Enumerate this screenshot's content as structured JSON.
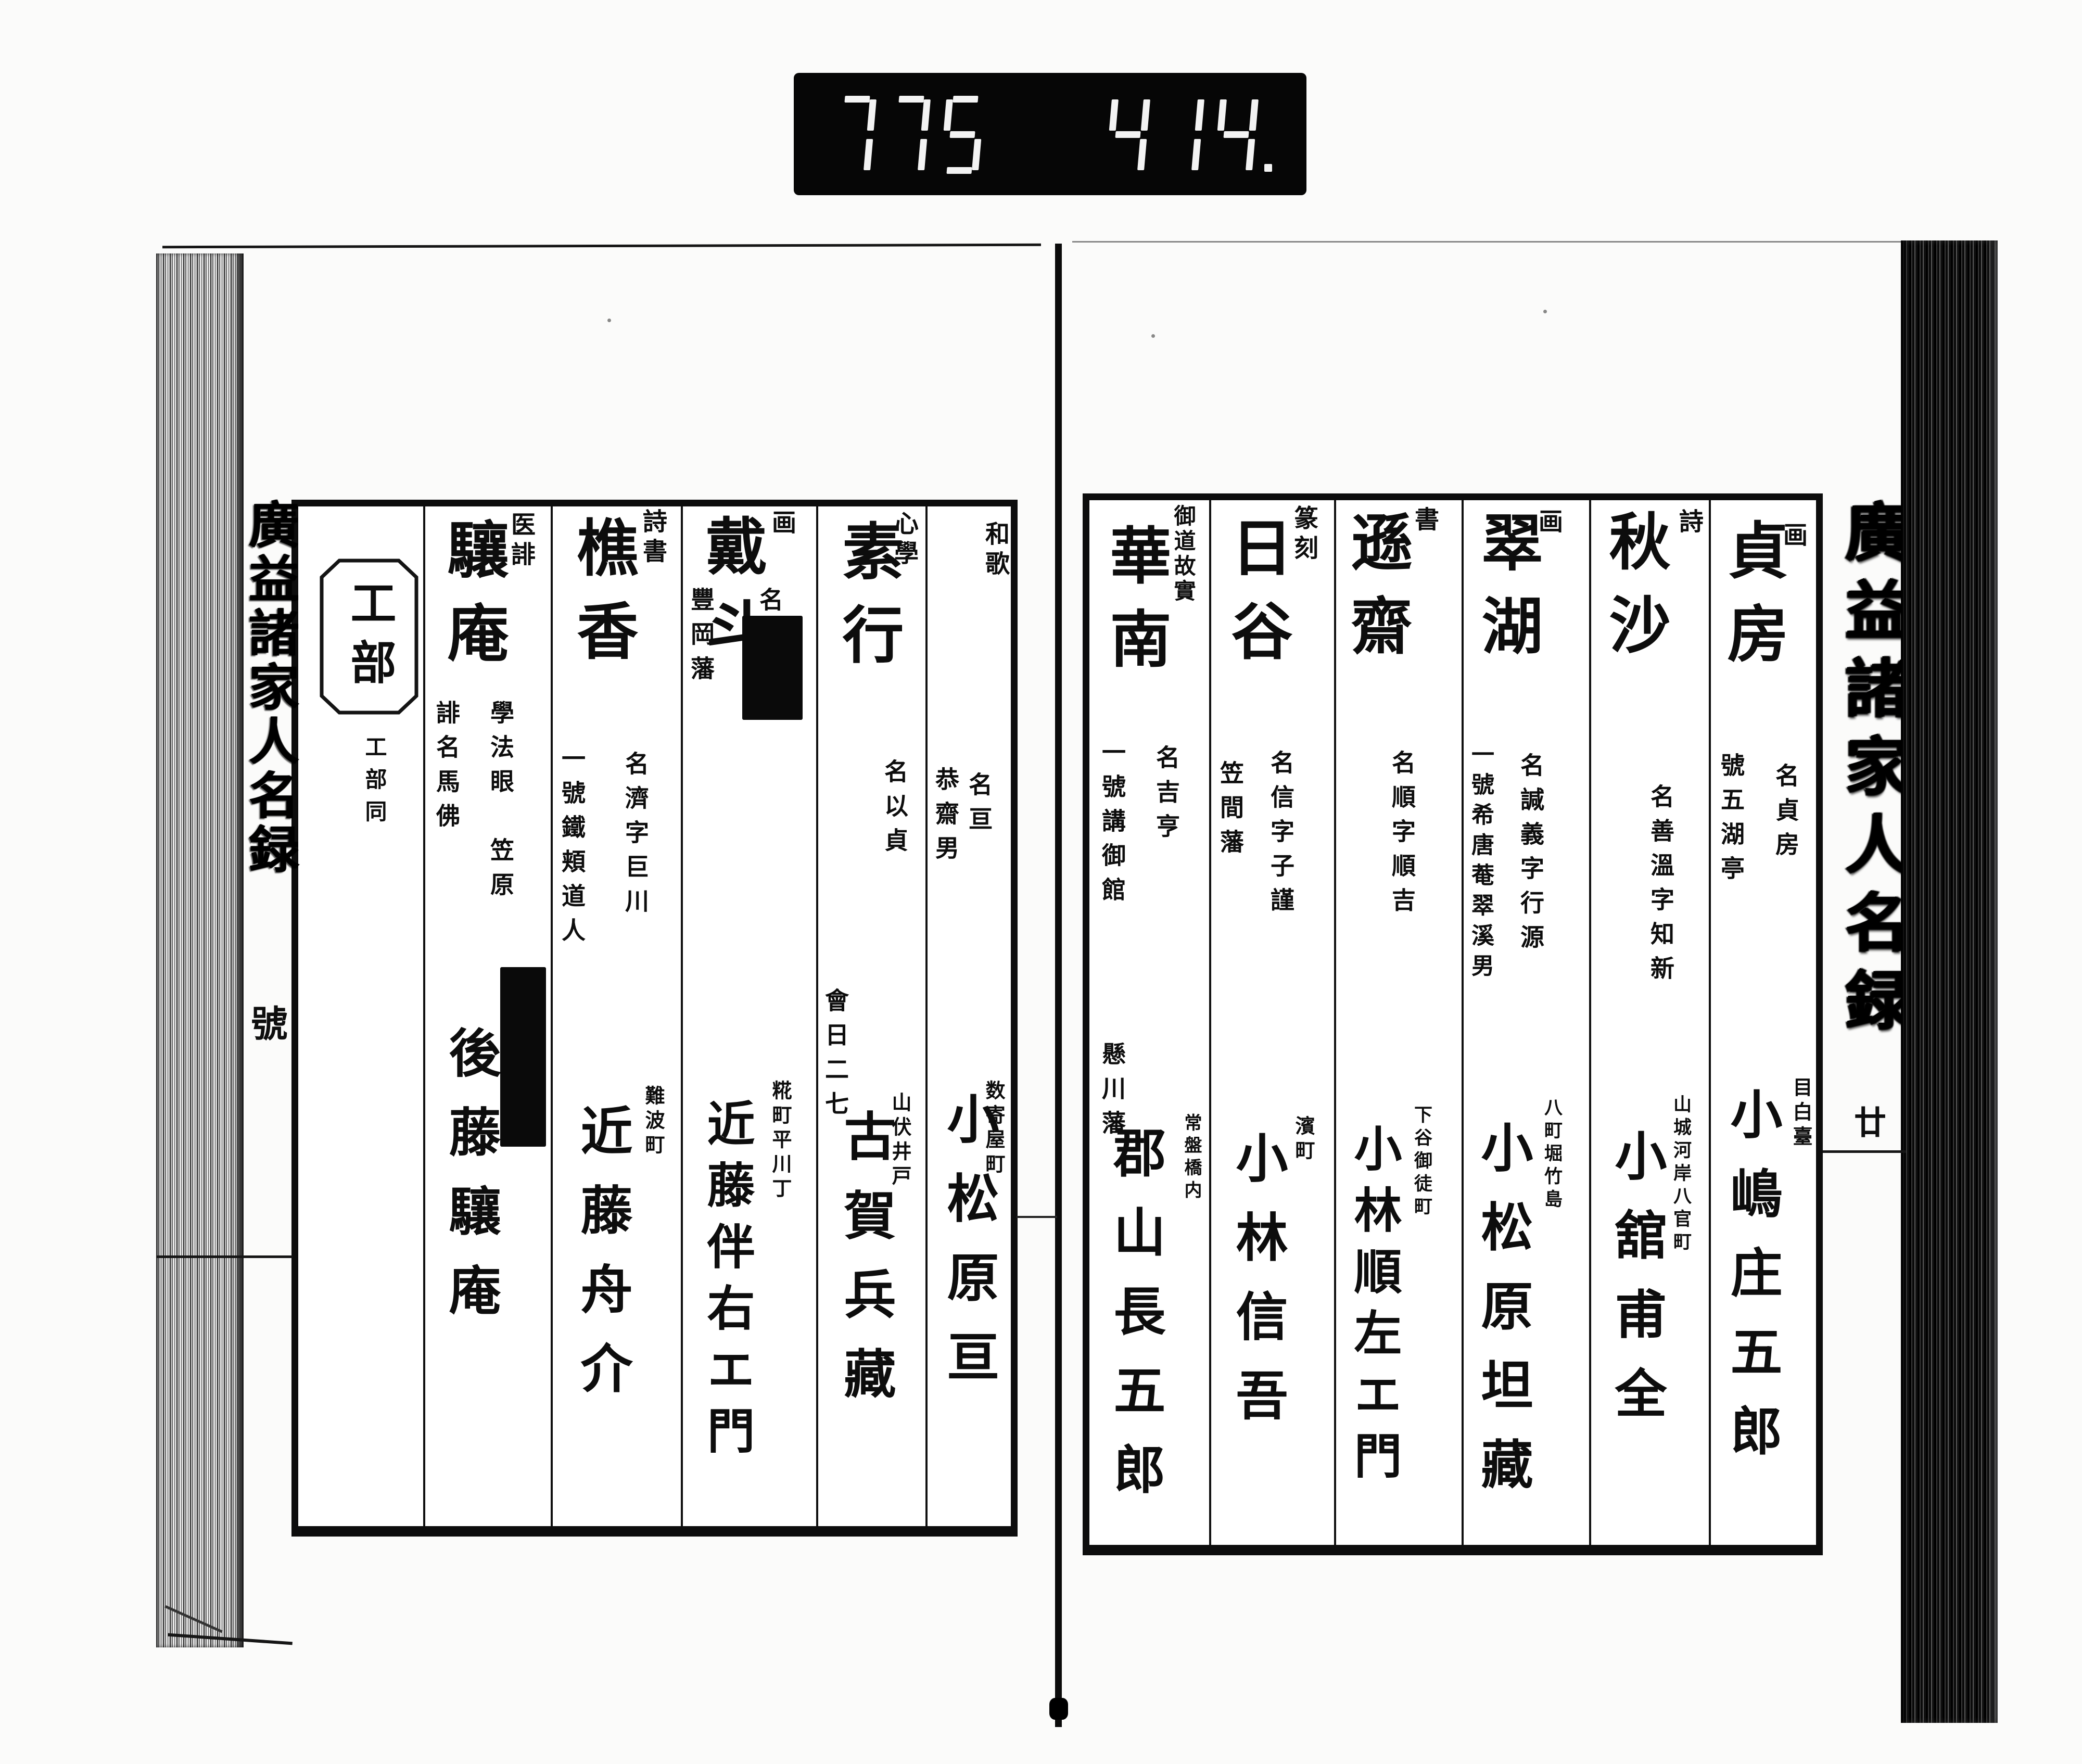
{
  "counter": {
    "left": "775",
    "right": "414."
  },
  "book": {
    "right_page": {
      "margin_title": "廣益諸家人名録",
      "margin_mark": "廿",
      "entries": [
        {
          "category": "画",
          "name": "貞房",
          "note_right": "名貞房",
          "note_left": "號五湖亭",
          "address": "目白臺",
          "person": "小嶋庄五郎"
        },
        {
          "category": "詩",
          "name": "秋沙",
          "note_right": "名善溫字知新",
          "note_left": "",
          "address": "山城河岸八官町",
          "person": "小舘甫全"
        },
        {
          "category": "画",
          "name": "翠湖",
          "note_right": "名諴義字行源",
          "note_left": "一號希唐菴翠溪男",
          "address": "八町堀竹島",
          "person": "小松原坦藏"
        },
        {
          "category": "書",
          "name": "遜齋",
          "note_right": "名順字順吉",
          "note_left": "",
          "address": "下谷御徒町",
          "person": "小林順左エ門"
        },
        {
          "category": "篆刻",
          "name": "日谷",
          "note_right": "名信字子謹",
          "note_left": "笠間藩",
          "address": "濱町",
          "person": "小林信吾"
        },
        {
          "category": "御道故實",
          "name": "華南",
          "note_right": "名吉亨",
          "note_left": "一號講御館",
          "note_left2": "懸川藩",
          "address": "常盤橋内",
          "person": "郡山長五郎"
        }
      ]
    },
    "left_page": {
      "margin_title": "廣益諸家人名録",
      "margin_mark": "號",
      "entries": [
        {
          "category": "和歌",
          "name": "",
          "note_right": "名亘",
          "note_left": "恭齋男",
          "address": "数寄屋町",
          "person": "小松原亘"
        },
        {
          "category": "心學",
          "name": "素行",
          "note_right": "名以貞",
          "note_left": "會日二七",
          "address": "山伏井戸",
          "person": "古賀兵藏"
        },
        {
          "category": "画",
          "name": "戴斗",
          "note_right": "名",
          "note_left": "豐岡藩",
          "address": "糀町平川丁",
          "person": "近藤伴右エ門"
        },
        {
          "category": "詩書",
          "name": "樵香",
          "note_right": "名濟字巨川",
          "note_left": "一號鐵頬道人",
          "address": "難波町",
          "person": "近藤舟介"
        },
        {
          "category": "医誹",
          "name": "驤庵",
          "note_right": "學法眼　笠原",
          "note_left": "誹名馬佛",
          "address": "",
          "person": "後藤驤庵"
        },
        {
          "category": "工部",
          "section_note": "工部同"
        }
      ]
    }
  }
}
